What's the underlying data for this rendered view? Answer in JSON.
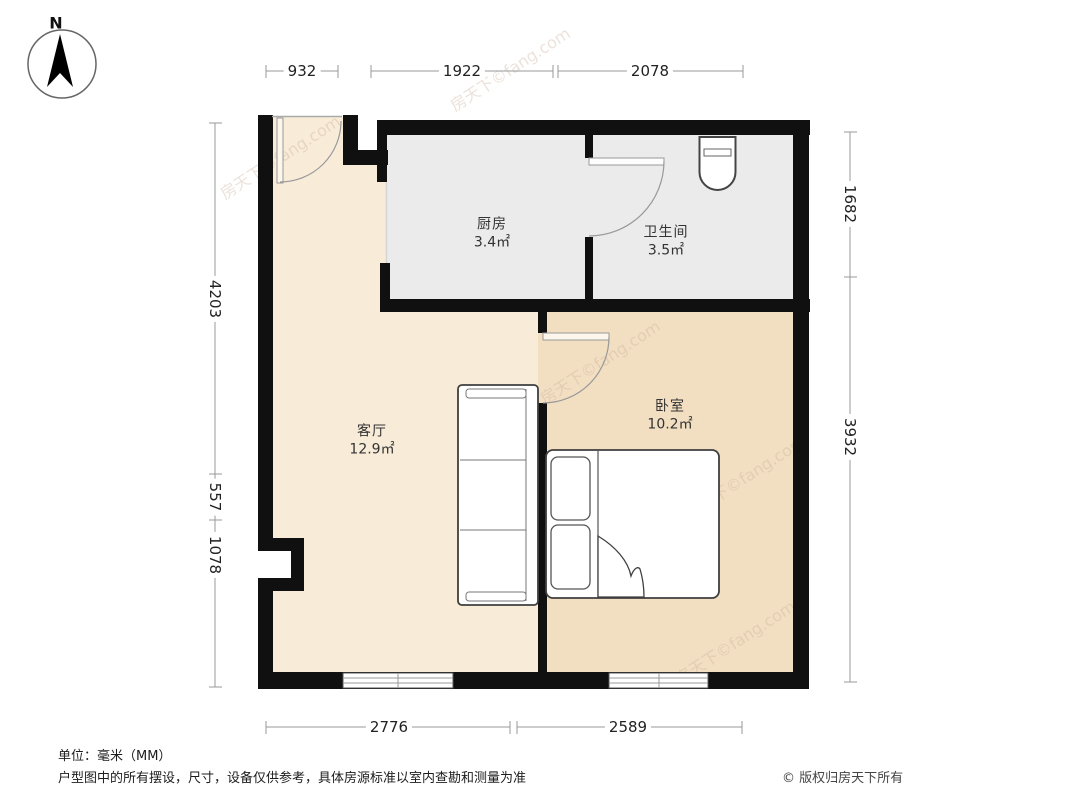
{
  "compass": {
    "label": "N"
  },
  "rooms": [
    {
      "id": "kitchen",
      "name": "厨房",
      "area": "3.4㎡"
    },
    {
      "id": "bathroom",
      "name": "卫生间",
      "area": "3.5㎡"
    },
    {
      "id": "living",
      "name": "客厅",
      "area": "12.9㎡"
    },
    {
      "id": "bedroom",
      "name": "卧室",
      "area": "10.2㎡"
    }
  ],
  "dimensions": {
    "top": [
      "932",
      "1922",
      "2078"
    ],
    "left": [
      "4203",
      "557",
      "1078"
    ],
    "right": [
      "1682",
      "3932"
    ],
    "bottom": [
      "2776",
      "2589"
    ]
  },
  "footer": {
    "unit": "单位：毫米（MM）",
    "disclaimer": "户型图中的所有摆设，尺寸，设备仅供参考，具体房源标准以室内查勘和测量为准",
    "copyright": "© 版权归房天下所有"
  },
  "watermark": {
    "text": "房天下©fang.com"
  },
  "colors": {
    "wall": "#101010",
    "living_floor": "#f8ecd9",
    "bedroom_floor": "#f2dfc2",
    "wet_floor": "#ebebeb",
    "dimension_line": "#9a9a9a",
    "dimension_text": "#222222",
    "label_text": "#333333"
  }
}
